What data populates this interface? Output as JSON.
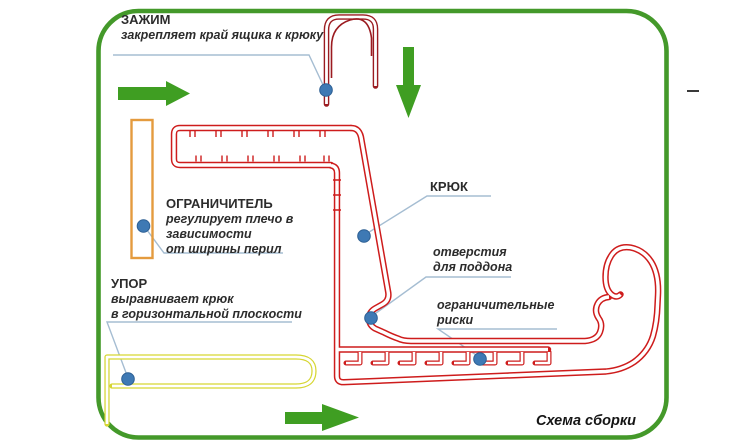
{
  "diagram": {
    "caption": "Схема сборки",
    "callouts": {
      "clamp": {
        "title": "ЗАЖИМ",
        "lines": [
          "закрепляет край ящика к крюку"
        ]
      },
      "limiter": {
        "title": "ОГРАНИЧИТЕЛЬ",
        "lines": [
          "регулирует плечо в",
          "зависимости",
          "от ширины перил"
        ]
      },
      "stop": {
        "title": "УПОР",
        "lines": [
          "выравнивает крюк",
          "в горизонтальной плоскости"
        ]
      },
      "hook": {
        "title": "КРЮК",
        "lines": []
      },
      "tray_holes": {
        "title": "",
        "lines": [
          "отверстия",
          "для поддона"
        ]
      },
      "limit_marks": {
        "title": "",
        "lines": [
          "ограничительные",
          "риски"
        ]
      }
    },
    "icons": [
      "arrow-right-icon",
      "arrow-down-icon",
      "marker-dot-icon"
    ],
    "colors": {
      "frame_green": "#44992a",
      "arrow_green": "#3f9e22",
      "profile_red": "#ce1c1c",
      "clamp_dark_red": "#9b1b20",
      "limiter_orange": "#e49b3e",
      "stop_yellow": "#d6d632",
      "marker_blue": "#3e79b4",
      "callout_line": "#a5bdd2",
      "text": "#2c2c2c"
    }
  }
}
